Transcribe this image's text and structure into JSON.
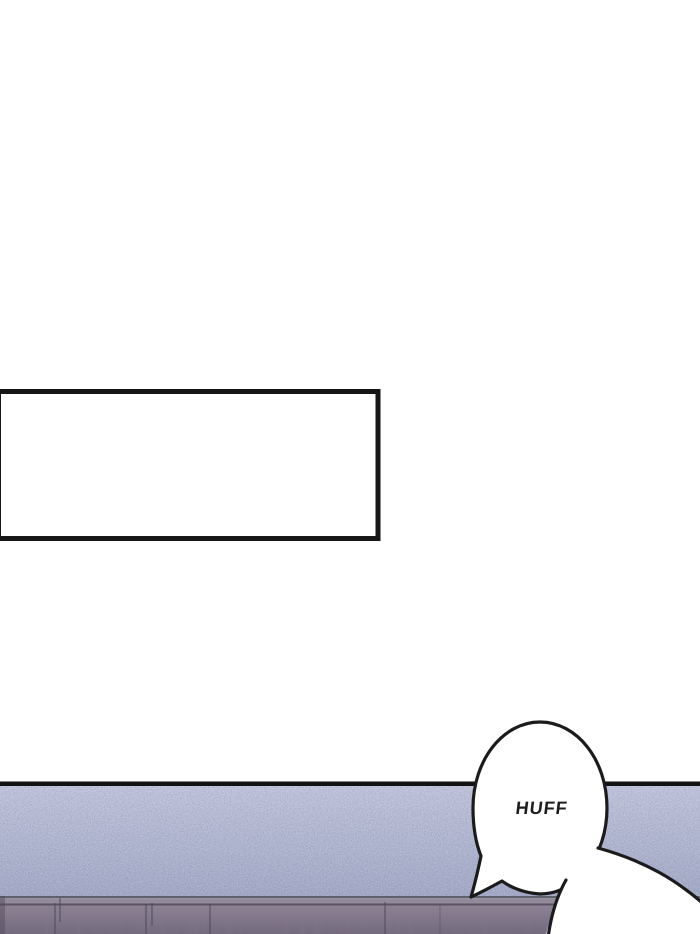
{
  "page": {
    "background": "#ffffff"
  },
  "caption_box": {
    "text": "",
    "border_color": "#161616",
    "fill": "#ffffff"
  },
  "panel": {
    "border_color": "#121212",
    "wall": {
      "top_color": "#c4c8e0",
      "bottom_color": "#a6adc9"
    },
    "cabinet": {
      "edge_color": "#5d616c",
      "top_band_color": "#948a9c",
      "seam_color": "#595362",
      "face_top_color": "#8c8294",
      "face_bottom_color": "#746a7e",
      "groove_color": "#4e4a5e"
    },
    "bubbles": {
      "fill": "#ffffff",
      "outline": "#1b1b1b",
      "sfx_text": "HUFF",
      "sfx_color": "#1d1d1d"
    }
  }
}
